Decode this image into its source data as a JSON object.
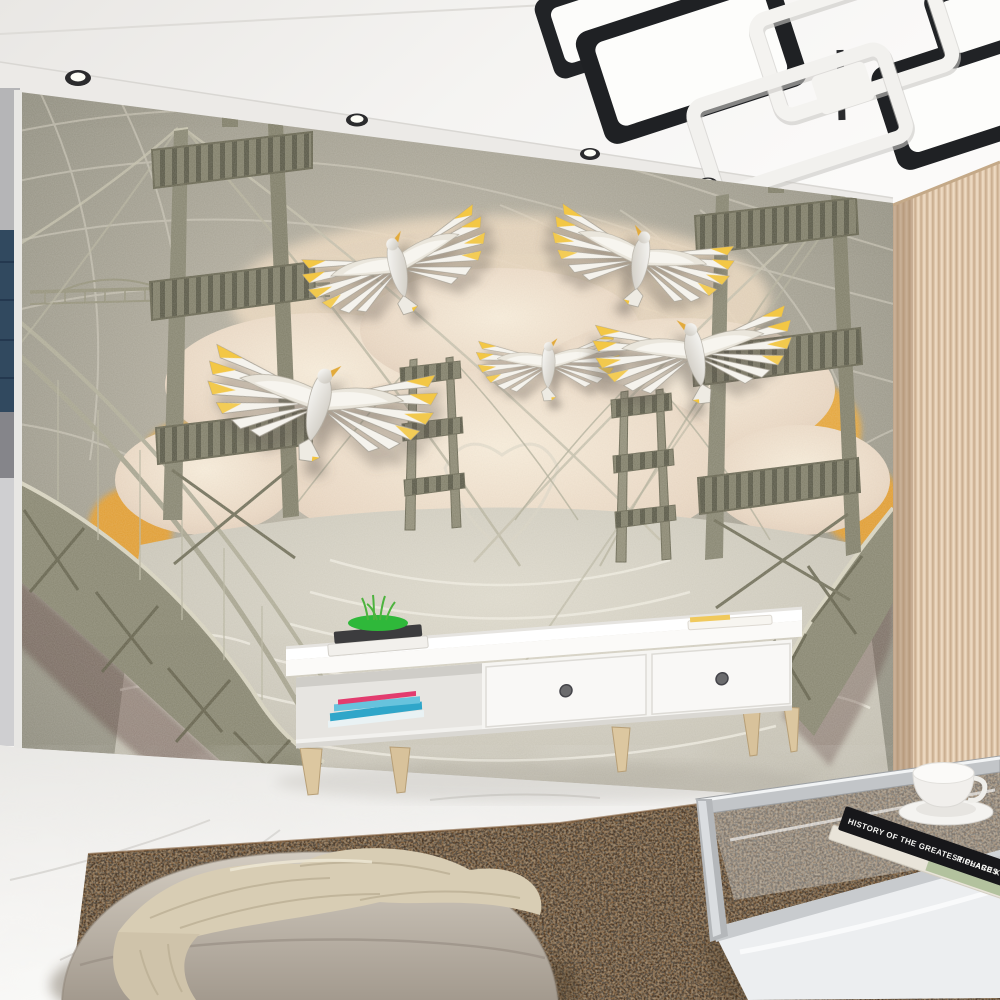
{
  "scene": {
    "description": "Bright living room with a sculpted sand-relief wall mural of suspension bridges and ceramic doves, modern white TV stand, glass coffee table, beige curtain, brown speckled rug, marble floor and a pouf with a knit throw",
    "wall_mural": {
      "theme": "Golden Gate style suspension bridges, clouds, sun glow and five flying doves",
      "base_color": "#a5a194",
      "cloud_color": "#ead9c5",
      "sun_glow_color": "#e2a73e",
      "dove_accent_color": "#f2c43c",
      "dove_count": 5
    },
    "ceiling": {
      "color": "#f4f3f1",
      "downlight_count": 4,
      "lamp_style": "black and white rectangular LED chandelier"
    },
    "curtain_color": "#e2cbb0",
    "floor_color": "#f2f1ee",
    "rug_color": "#a87a4e",
    "tv_stand": {
      "color": "#fbfaf8",
      "drawer_count": 2,
      "leg_color": "#d8c49d"
    },
    "coffee_table": {
      "book_spine_title": "HISTORY OF THE GREATEST PLACES",
      "book_spine_author": "RICHARD KOCH"
    },
    "pouf_color": "#c8bfb4"
  }
}
